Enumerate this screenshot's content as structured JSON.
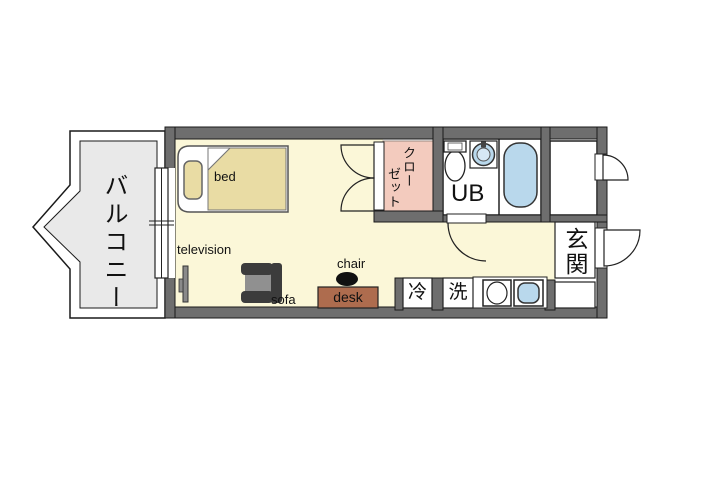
{
  "balcony": {
    "label": "バルコニー"
  },
  "room": {
    "bed_label": "bed",
    "television_label": "television",
    "sofa_label": "sofa",
    "chair_label": "chair",
    "desk_label": "desk"
  },
  "closet": {
    "label": "クローゼット",
    "line1": "クロー",
    "line2": "ゼット"
  },
  "unit_bath": {
    "label": "UB"
  },
  "entrance": {
    "label": "玄関"
  },
  "appliances": {
    "refrigerator": "冷",
    "washing_machine": "洗"
  },
  "colors": {
    "wall": "#6E6E6E",
    "room_floor": "#FBF7D8",
    "closet": "#F3CBBE",
    "water": "#B9D8EC",
    "bed": "#E9DCA4",
    "desk": "#AE6C4E",
    "balcony_floor": "#E9E9E9"
  }
}
